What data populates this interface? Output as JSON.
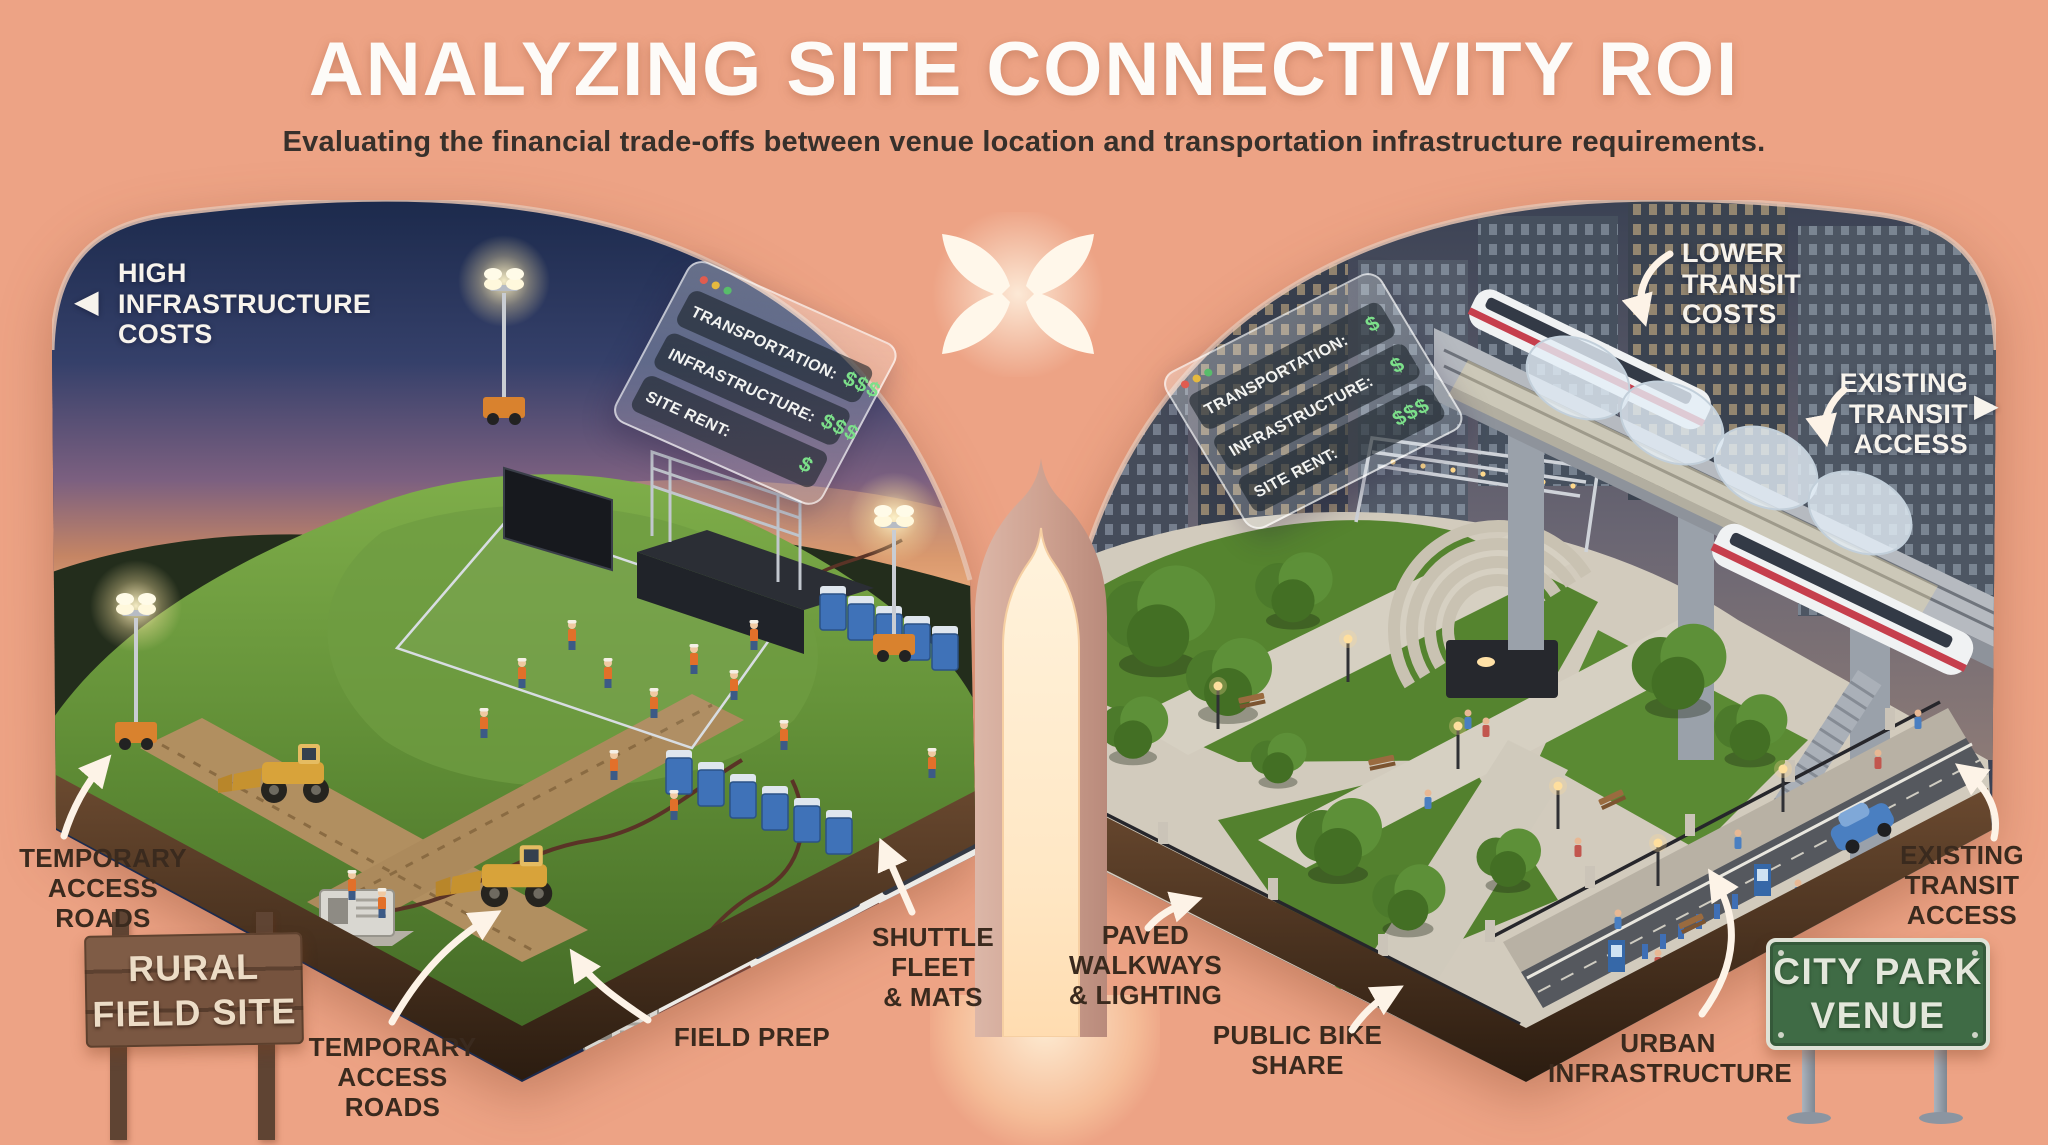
{
  "header": {
    "title": "ANALYZING SITE CONNECTIVITY ROI",
    "subtitle": "Evaluating the financial trade-offs between venue location and transportation infrastructure requirements."
  },
  "icons": {
    "arrow_left": "◀",
    "arrow_right": "▶"
  },
  "left_panel": {
    "name": "Rural Field Site",
    "callout_infrastructure": {
      "line1": "HIGH",
      "line2": "INFRASTRUCTURE",
      "line3": "COSTS"
    },
    "cost_card": {
      "row1": {
        "label": "TRANSPORTATION:",
        "value": "$$$"
      },
      "row2": {
        "label": "INFRASTRUCTURE:",
        "value": "$$$"
      },
      "row3": {
        "label": "SITE RENT:",
        "value": "$"
      }
    },
    "annotations": {
      "temp_roads_left": {
        "line1": "TEMPORARY",
        "line2": "ACCESS ROADS"
      },
      "temp_roads_center": {
        "line1": "TEMPORARY",
        "line2": "ACCESS ROADS"
      },
      "field_prep": {
        "line1": "FIELD PREP"
      },
      "shuttle_fleet": {
        "line1": "SHUTTLE FLEET",
        "line2": "& MATS"
      }
    },
    "sign": {
      "line1": "RURAL",
      "line2": "FIELD SITE"
    }
  },
  "right_panel": {
    "name": "City Park Venue",
    "callout_transit_costs": {
      "line1": "LOWER",
      "line2": "TRANSIT",
      "line3": "COSTS"
    },
    "callout_transit_access": {
      "line1": "EXISTING",
      "line2": "TRANSIT",
      "line3": "ACCESS"
    },
    "cost_card": {
      "row1": {
        "label": "TRANSPORTATION:",
        "value": "$"
      },
      "row2": {
        "label": "INFRASTRUCTURE:",
        "value": "$"
      },
      "row3": {
        "label": "SITE RENT:",
        "value": "$$$"
      }
    },
    "annotations": {
      "paved_walkways": {
        "line1": "PAVED",
        "line2": "WALKWAYS",
        "line3": "& LIGHTING"
      },
      "public_bike_share": {
        "line1": "PUBLIC BIKE",
        "line2": "SHARE"
      },
      "urban_infrastructure": {
        "line1": "URBAN",
        "line2": "INFRASTRUCTURE"
      },
      "existing_transit_bottom": {
        "line1": "EXISTING",
        "line2": "TRANSIT",
        "line3": "ACCESS"
      }
    },
    "sign": {
      "line1": "CITY PARK",
      "line2": "VENUE"
    }
  },
  "colors": {
    "background": "#eda385",
    "dollar_green": "#7ce08a",
    "label_text": "#3a2a1e",
    "arrow_white": "#fdf3e7",
    "wood_sign": "#76533e",
    "green_sign": "#3f6b45"
  }
}
